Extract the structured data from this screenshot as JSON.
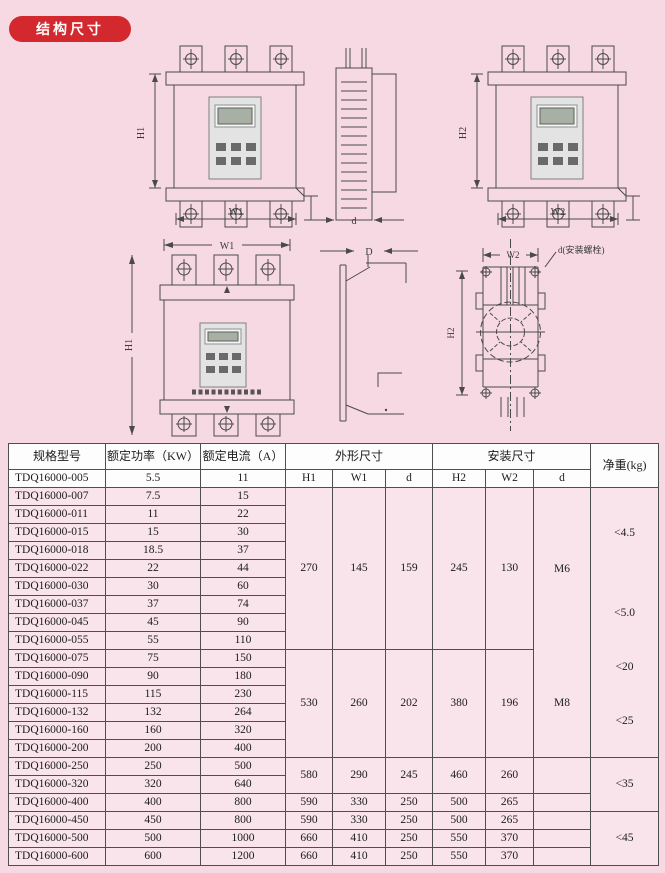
{
  "title": "结构尺寸",
  "colors": {
    "page_bg": "#f7d9e3",
    "accent_red": "#d2282e",
    "table_cell_bg": "#f9e4ec",
    "header_bg": "#fefdfd",
    "border": "#4f4f4f",
    "line": "#4a4a4a"
  },
  "drawings": {
    "top_left": {
      "h": "H1",
      "w": "W1"
    },
    "top_mid": {
      "d": "d"
    },
    "top_right": {
      "h": "H2",
      "w": "W2"
    },
    "bot_left": {
      "h": "H1",
      "w": "W1"
    },
    "bot_mid": {
      "d": "D"
    },
    "bot_right": {
      "h": "H2",
      "w": "W2",
      "note": "d(安装螺栓)"
    }
  },
  "table": {
    "col_headers": {
      "model": "规格型号",
      "power": "额定功率（KW）",
      "current": "额定电流（A）",
      "outline": "外形尺寸",
      "mount": "安装尺寸",
      "weight": "净重(kg)"
    },
    "sub_headers": {
      "h1": "H1",
      "w1": "W1",
      "d1": "d",
      "h2": "H2",
      "w2": "W2",
      "d2": "d"
    },
    "rows": [
      {
        "model": "TDQ16000-005",
        "power": "5.5",
        "current": "11"
      },
      {
        "model": "TDQ16000-007",
        "power": "7.5",
        "current": "15"
      },
      {
        "model": "TDQ16000-011",
        "power": "11",
        "current": "22"
      },
      {
        "model": "TDQ16000-015",
        "power": "15",
        "current": "30"
      },
      {
        "model": "TDQ16000-018",
        "power": "18.5",
        "current": "37"
      },
      {
        "model": "TDQ16000-022",
        "power": "22",
        "current": "44"
      },
      {
        "model": "TDQ16000-030",
        "power": "30",
        "current": "60"
      },
      {
        "model": "TDQ16000-037",
        "power": "37",
        "current": "74"
      },
      {
        "model": "TDQ16000-045",
        "power": "45",
        "current": "90"
      },
      {
        "model": "TDQ16000-055",
        "power": "55",
        "current": "110"
      },
      {
        "model": "TDQ16000-075",
        "power": "75",
        "current": "150"
      },
      {
        "model": "TDQ16000-090",
        "power": "90",
        "current": "180"
      },
      {
        "model": "TDQ16000-115",
        "power": "115",
        "current": "230"
      },
      {
        "model": "TDQ16000-132",
        "power": "132",
        "current": "264"
      },
      {
        "model": "TDQ16000-160",
        "power": "160",
        "current": "320"
      },
      {
        "model": "TDQ16000-200",
        "power": "200",
        "current": "400"
      },
      {
        "model": "TDQ16000-250",
        "power": "250",
        "current": "500"
      },
      {
        "model": "TDQ16000-320",
        "power": "320",
        "current": "640"
      },
      {
        "model": "TDQ16000-400",
        "power": "400",
        "current": "800"
      },
      {
        "model": "TDQ16000-450",
        "power": "450",
        "current": "800"
      },
      {
        "model": "TDQ16000-500",
        "power": "500",
        "current": "1000"
      },
      {
        "model": "TDQ16000-600",
        "power": "600",
        "current": "1200"
      }
    ],
    "dims": {
      "g1": {
        "h1": "270",
        "w1": "145",
        "d": "159",
        "h2": "245",
        "w2": "130",
        "bolt": "M6"
      },
      "g2": {
        "h1": "530",
        "w1": "260",
        "d": "202",
        "h2": "380",
        "w2": "196",
        "bolt": "M8"
      },
      "g3": {
        "h1": "580",
        "w1": "290",
        "d": "245",
        "h2": "460",
        "w2": "260"
      },
      "r400": {
        "h1": "590",
        "w1": "330",
        "d": "250",
        "h2": "500",
        "w2": "265"
      },
      "r450": {
        "h1": "590",
        "w1": "330",
        "d": "250",
        "h2": "500",
        "w2": "265"
      },
      "r500": {
        "h1": "660",
        "w1": "410",
        "d": "250",
        "h2": "550",
        "w2": "370"
      },
      "r600": {
        "h1": "660",
        "w1": "410",
        "d": "250",
        "h2": "550",
        "w2": "370"
      }
    },
    "weights": {
      "w1": "<4.5",
      "w2": "<5.0",
      "w3": "<20",
      "w4": "<25",
      "w5": "<35",
      "w6": "<45"
    }
  }
}
